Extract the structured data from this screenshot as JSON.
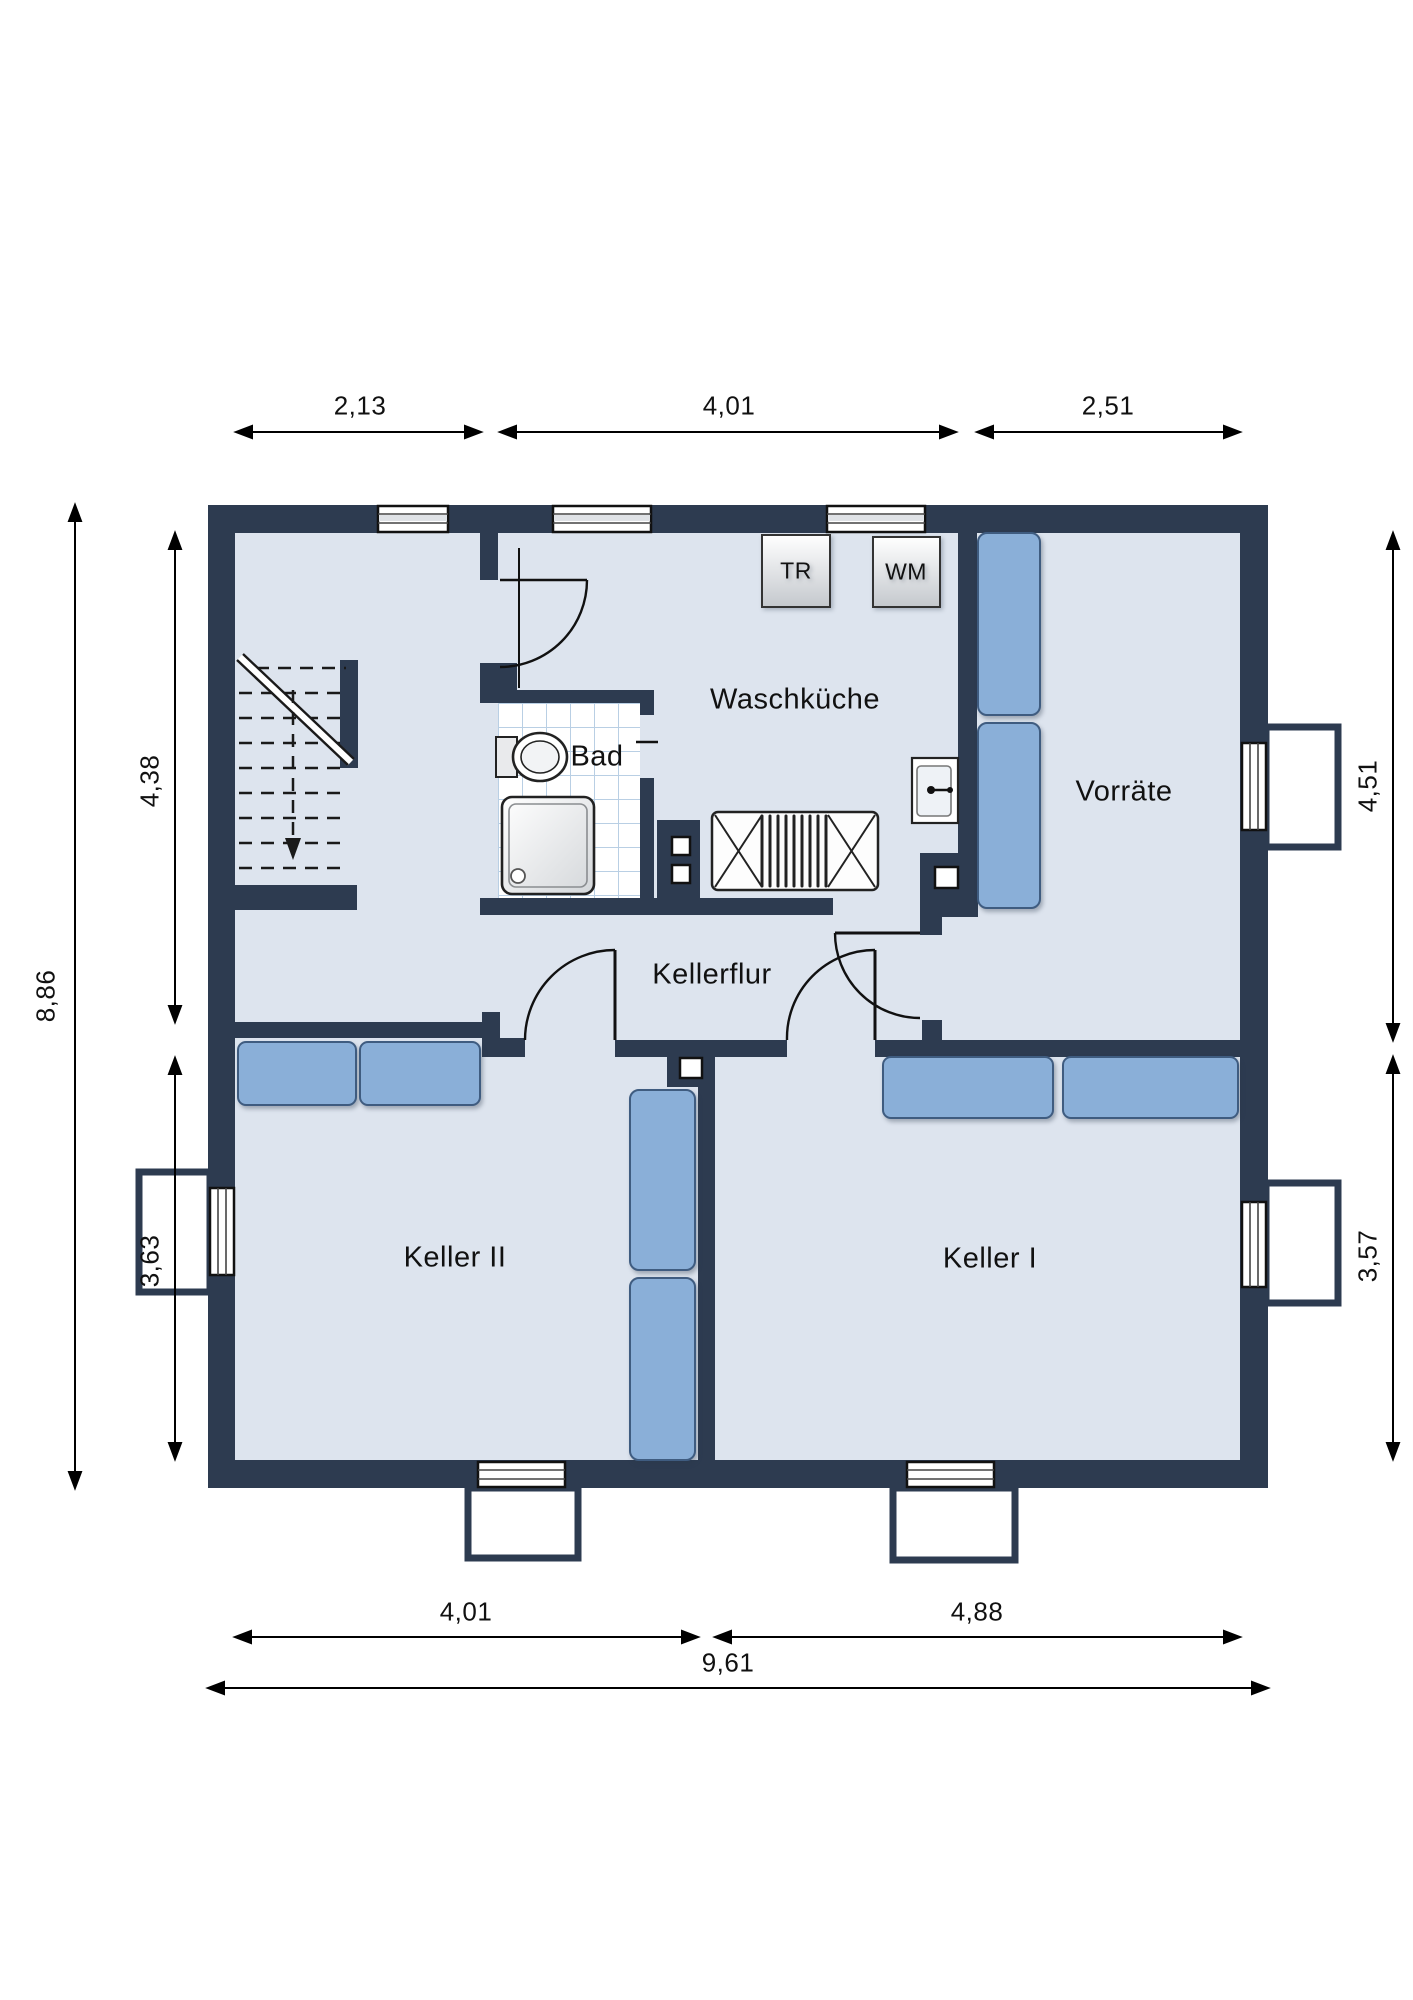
{
  "rooms": {
    "waschkueche": "Waschküche",
    "bad": "Bad",
    "vorraete": "Vorräte",
    "kellerflur": "Kellerflur",
    "keller_2": "Keller II",
    "keller_1": "Keller I"
  },
  "appliances": {
    "dryer_label": "TR",
    "washing_machine_label": "WM"
  },
  "dimensions": {
    "top": {
      "stair_room_width": "2,13",
      "waschkueche_width": "4,01",
      "vorraete_width": "2,51"
    },
    "bottom": {
      "keller_2_width": "4,01",
      "keller_1_width": "4,88",
      "total_width": "9,61"
    },
    "left": {
      "total_depth": "8,86",
      "upper_depth": "4,38",
      "lower_depth": "3,63"
    },
    "right": {
      "vorraete_depth": "4,51",
      "keller_1_depth": "3,57"
    }
  },
  "colors": {
    "wall": "#2d3b50",
    "floor": "#dde4ee",
    "furniture_blue": "#8aafd8",
    "furniture_blue_border": "#3f5c80",
    "tile_grid": "#b9cfe4",
    "line": "#111111"
  }
}
